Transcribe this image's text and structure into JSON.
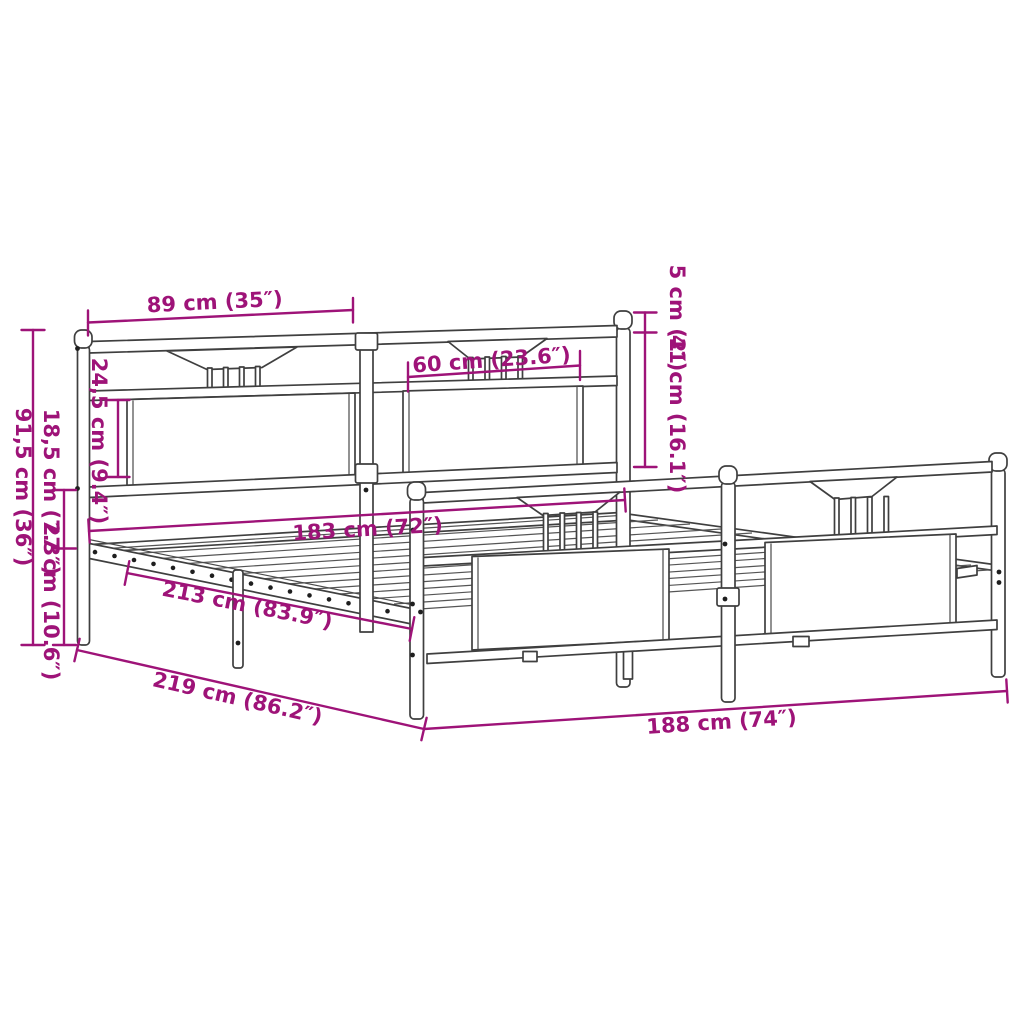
{
  "diagram": {
    "title": "Metal bed frame with headboard and footboard - dimension drawing",
    "background_color": "#ffffff",
    "drawing_line_color": "#3f3f3f",
    "dimension_color": "#9e1378",
    "units": "cm (inches)",
    "dimensions": {
      "headboard_section_width": {
        "label": "89 cm (35″)"
      },
      "bracket_width": {
        "label": "60 cm (23.6″)"
      },
      "post_above_rail": {
        "label": "5 cm (2″)"
      },
      "headboard_upper_height": {
        "label": "41 cm (16.1″)"
      },
      "panel_height": {
        "label": "24,5 cm (9.4″)"
      },
      "headboard_total_height": {
        "label": "91,5 cm (36″)"
      },
      "rail_height": {
        "label": "18,5 cm (7.3″)"
      },
      "underbed_clearance": {
        "label": "27 cm (10.6″)"
      },
      "inner_width": {
        "label": "183 cm (72″)"
      },
      "inner_length": {
        "label": "213 cm (83.9″)"
      },
      "outer_length": {
        "label": "219 cm (86.2″)"
      },
      "outer_width": {
        "label": "188 cm (74″)"
      }
    }
  }
}
